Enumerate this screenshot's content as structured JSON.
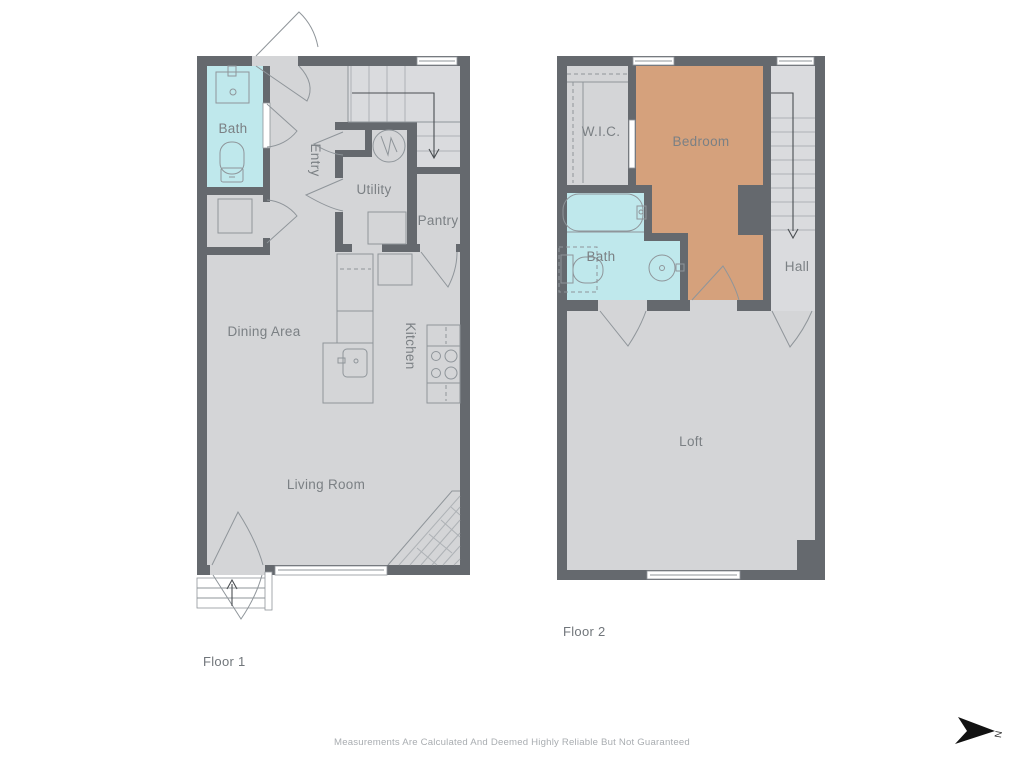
{
  "colors": {
    "wall": "#65696e",
    "floor": "#d4d5d7",
    "stairfloor": "#dadbde",
    "bath": "#bfe8ec",
    "bedroom": "#d5a17c",
    "window": "#ffffff",
    "line": "#8f959a",
    "tread": "#aeb2b6",
    "label": "#7b8084",
    "title": "#71767b",
    "muted": "#a9adb1",
    "arrow": "#4a4e52",
    "compass": "#121212"
  },
  "floor1": {
    "title": "Floor 1",
    "rooms": {
      "bath": "Bath",
      "entry": "Entry",
      "utility": "Utility",
      "pantry": "Pantry",
      "dining": "Dining Area",
      "kitchen": "Kitchen",
      "living": "Living Room"
    }
  },
  "floor2": {
    "title": "Floor 2",
    "rooms": {
      "wic": "W.I.C.",
      "bedroom": "Bedroom",
      "bath": "Bath",
      "hall": "Hall",
      "loft": "Loft"
    }
  },
  "compass": {
    "north_label": "N"
  },
  "footer": {
    "disclaimer": "Measurements Are Calculated And Deemed Highly Reliable But Not Guaranteed"
  }
}
